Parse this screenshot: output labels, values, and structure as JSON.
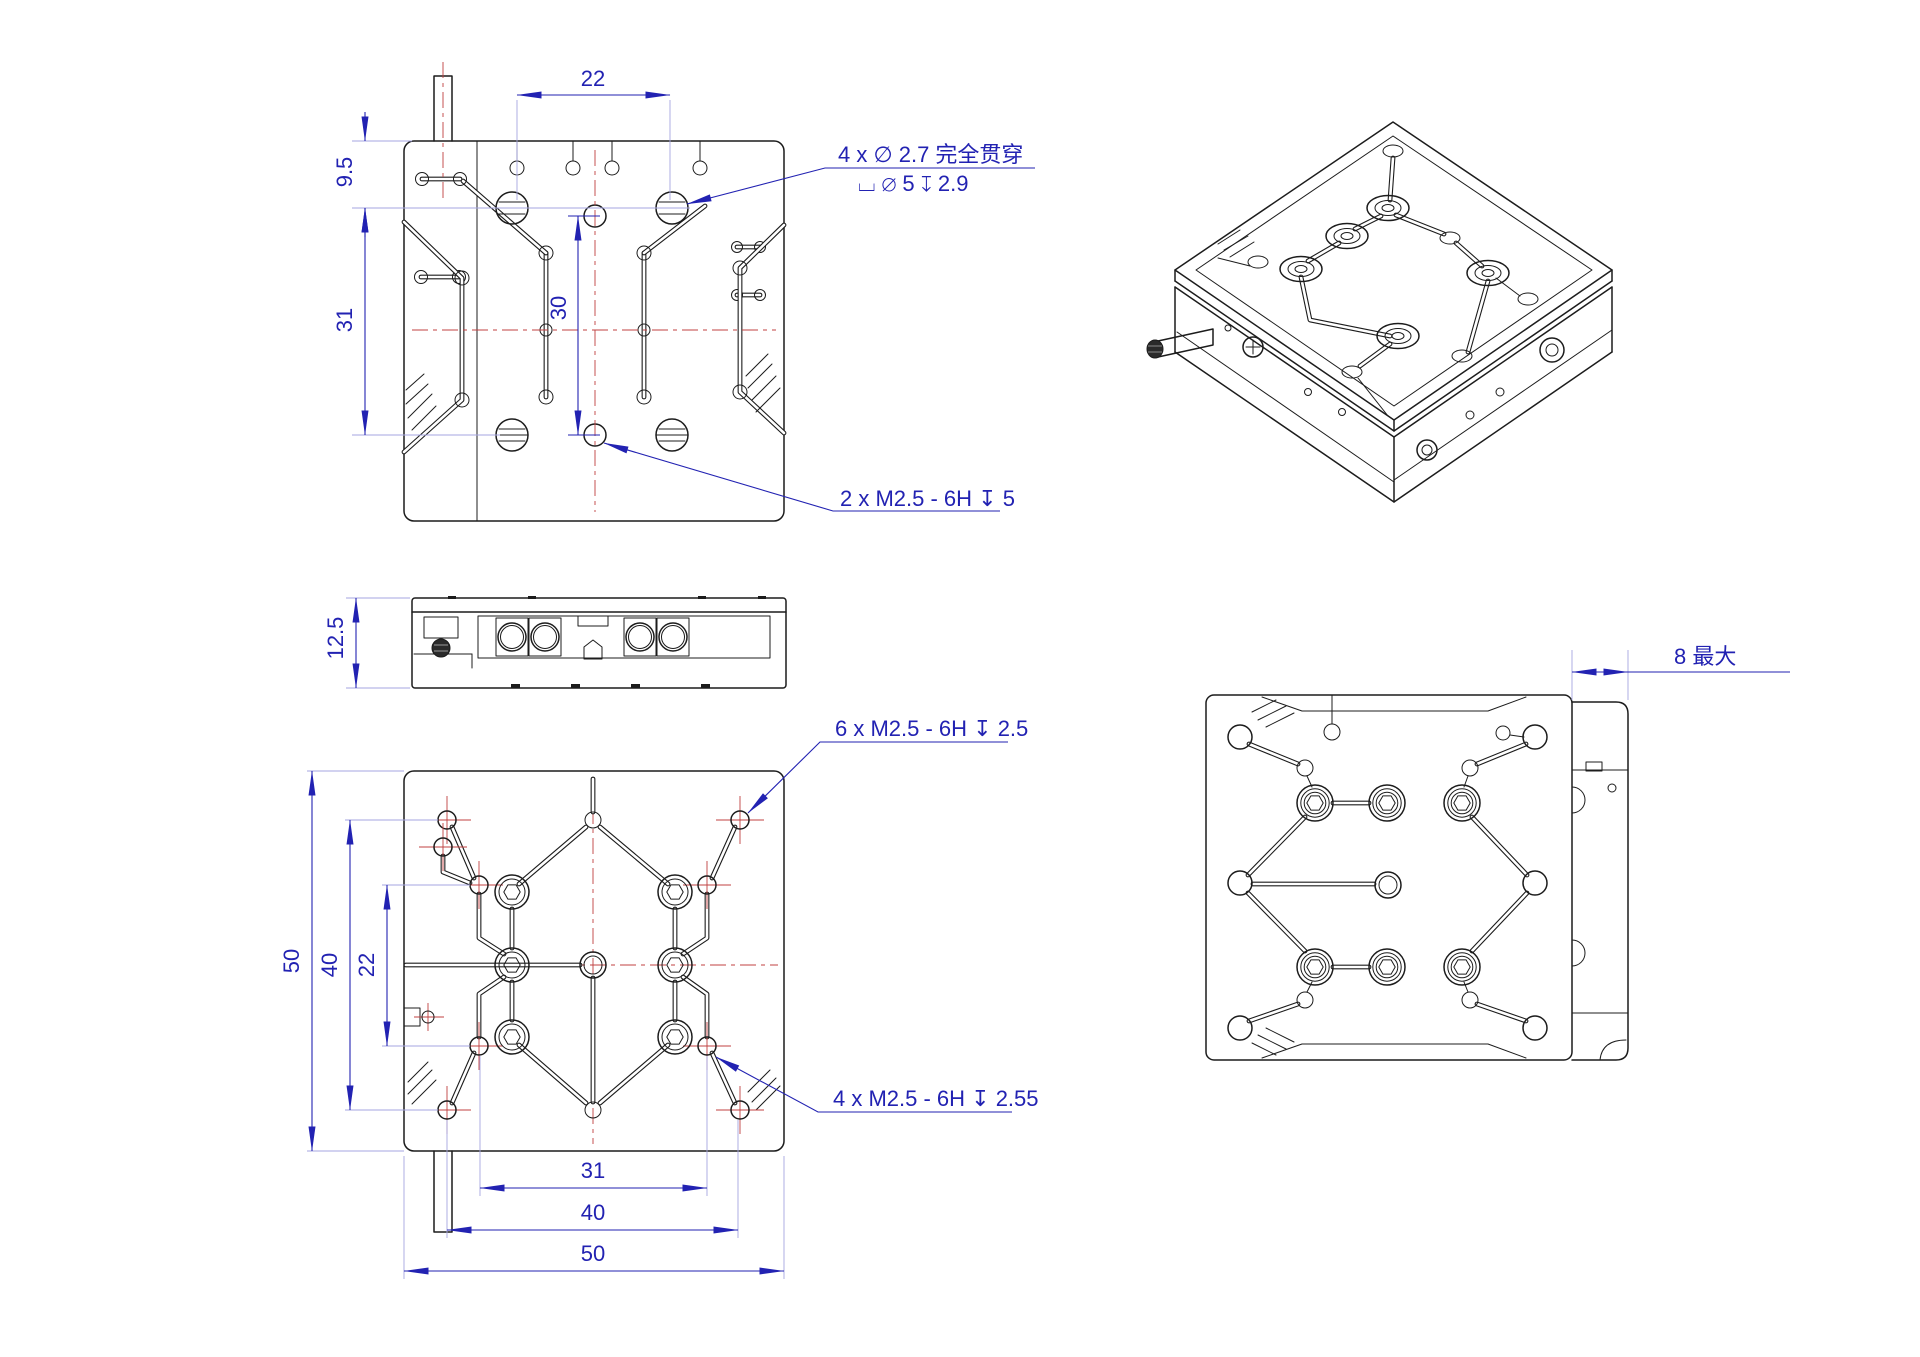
{
  "colors": {
    "background": "#ffffff",
    "line": "#1c1c1c",
    "dimension_blue": "#2222b2",
    "centerline_red": "#c04040",
    "extension_light_blue": "#a6a6e0"
  },
  "top_view": {
    "dim_hole_cols": "22",
    "dim_edge_offset": "9.5",
    "dim_hole_rows": "31",
    "dim_thread_rows": "30",
    "note_counterbore_line1": "4 x ∅ 2.7 完全贯穿",
    "note_counterbore_line2": "⌴ ∅ 5 ↧ 2.9",
    "note_thread": "2 x M2.5 - 6H ↧ 5"
  },
  "side_view": {
    "dim_height": "12.5"
  },
  "bottom_view": {
    "dim_v_50": "50",
    "dim_v_40": "40",
    "dim_v_22": "22",
    "dim_h_31": "31",
    "dim_h_40": "40",
    "dim_h_50": "50",
    "note_thread_6": "6 x M2.5 - 6H ↧ 2.5",
    "note_thread_4": "4 x M2.5 - 6H ↧ 2.55"
  },
  "rear_view": {
    "dim_8_max": "8 最大"
  }
}
